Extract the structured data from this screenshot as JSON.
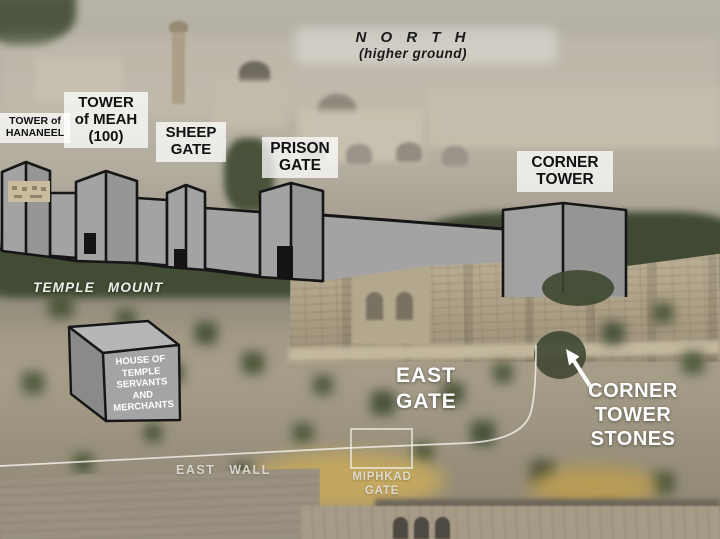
{
  "scene": "Annotated photograph of Jerusalem Temple Mount east side with reconstructed north wall diagram",
  "north": {
    "title": "N O R T H",
    "subtitle": "(higher ground)"
  },
  "labels": {
    "tower_hananeel": {
      "lines": [
        "TOWER of",
        "HANANEEL"
      ]
    },
    "tower_meah": {
      "lines": [
        "TOWER",
        "of MEAH",
        "(100)"
      ]
    },
    "sheep_gate": {
      "lines": [
        "SHEEP",
        "GATE"
      ]
    },
    "prison_gate": {
      "lines": [
        "PRISON",
        "GATE"
      ]
    },
    "corner_tower": {
      "lines": [
        "CORNER",
        "TOWER"
      ]
    },
    "temple_mount": {
      "text": "TEMPLE MOUNT"
    },
    "house_of_temple_servants": {
      "lines": [
        "HOUSE OF",
        "TEMPLE",
        "SERVANTS",
        "AND",
        "MERCHANTS"
      ]
    },
    "east_gate": {
      "lines": [
        "EAST",
        "GATE"
      ]
    },
    "corner_tower_stones": {
      "lines": [
        "CORNER",
        "TOWER",
        "STONES"
      ]
    },
    "east_wall": {
      "text": "EAST WALL"
    },
    "miphkad_gate": {
      "lines": [
        "MIPHKAD",
        "GATE"
      ]
    }
  },
  "colors": {
    "overlay_wall_fill": "#a8a8a8",
    "overlay_outline": "#161616",
    "label_box_bg": "rgba(255,255,255,0.75)",
    "label_text": "#111111",
    "white_annotation_text": "#ffffff",
    "faded_annotation_text": "#e4e3db",
    "path_line": "#f0efe8",
    "photo_stone_wall": "#ac9f85",
    "photo_trees": "#424c35"
  }
}
